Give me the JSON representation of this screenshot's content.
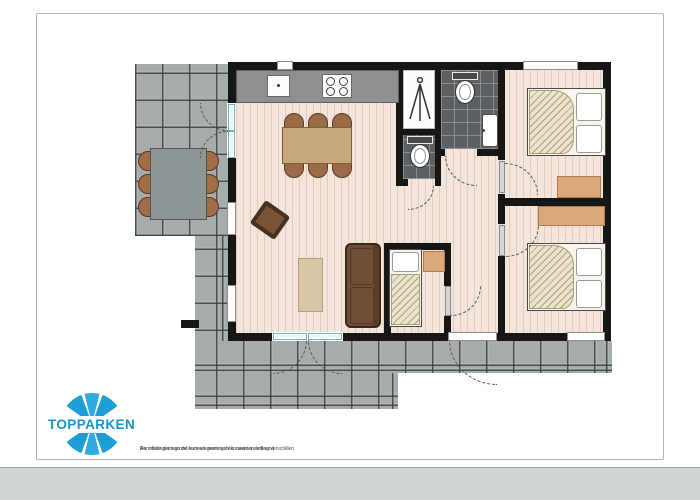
{
  "page": {
    "background_color": "#ffffff",
    "border_color": "#b5b5b5",
    "bottom_band_color": "#d0d4d5"
  },
  "logo": {
    "text": "TOPPARKEN",
    "brand_blue": "#1d9ed8",
    "brand_blue_light": "#2fabdf"
  },
  "disclaimer": {
    "part1": "Aan deze plattegrond kunnen geen rechten worden ontleend",
    "bullet": "•",
    "part2": "De indelingen van de recreatiewoningen kunnen onderling verschillen"
  },
  "plan": {
    "type": "holiday-home floor plan, top view, no text labels",
    "rooms": [
      "living-room",
      "kitchen",
      "bathroom",
      "shower-room",
      "toilet-room",
      "hallway",
      "bedroom-1-double",
      "bedroom-2-double",
      "bedroom-3-single",
      "terrace-left",
      "terrace-bottom"
    ],
    "furniture": [
      "kitchen-counter",
      "sink",
      "stove-4-burners",
      "dining-table-6-chairs",
      "rotated-armchair",
      "rug-cabinet",
      "sofa-2-seat",
      "single-bed",
      "nightstand",
      "double-bed-1",
      "double-bed-2",
      "wardrobe-1",
      "wardrobe-2",
      "outdoor-table-6-chairs",
      "toilet-top",
      "toilet-wc",
      "washbasin",
      "shower-symbol"
    ],
    "colors": {
      "terrace_tile": "#a6acac",
      "wall": "#161616",
      "wood_floor": "#f3e5d9",
      "bathroom_tile": "#5c6062",
      "dining_table": "#c7a77b",
      "sofa": "#6e4e39",
      "wardrobe": "#dba87c",
      "duvet": "#ece3cb",
      "door_glass": "#e7f8f9"
    }
  }
}
